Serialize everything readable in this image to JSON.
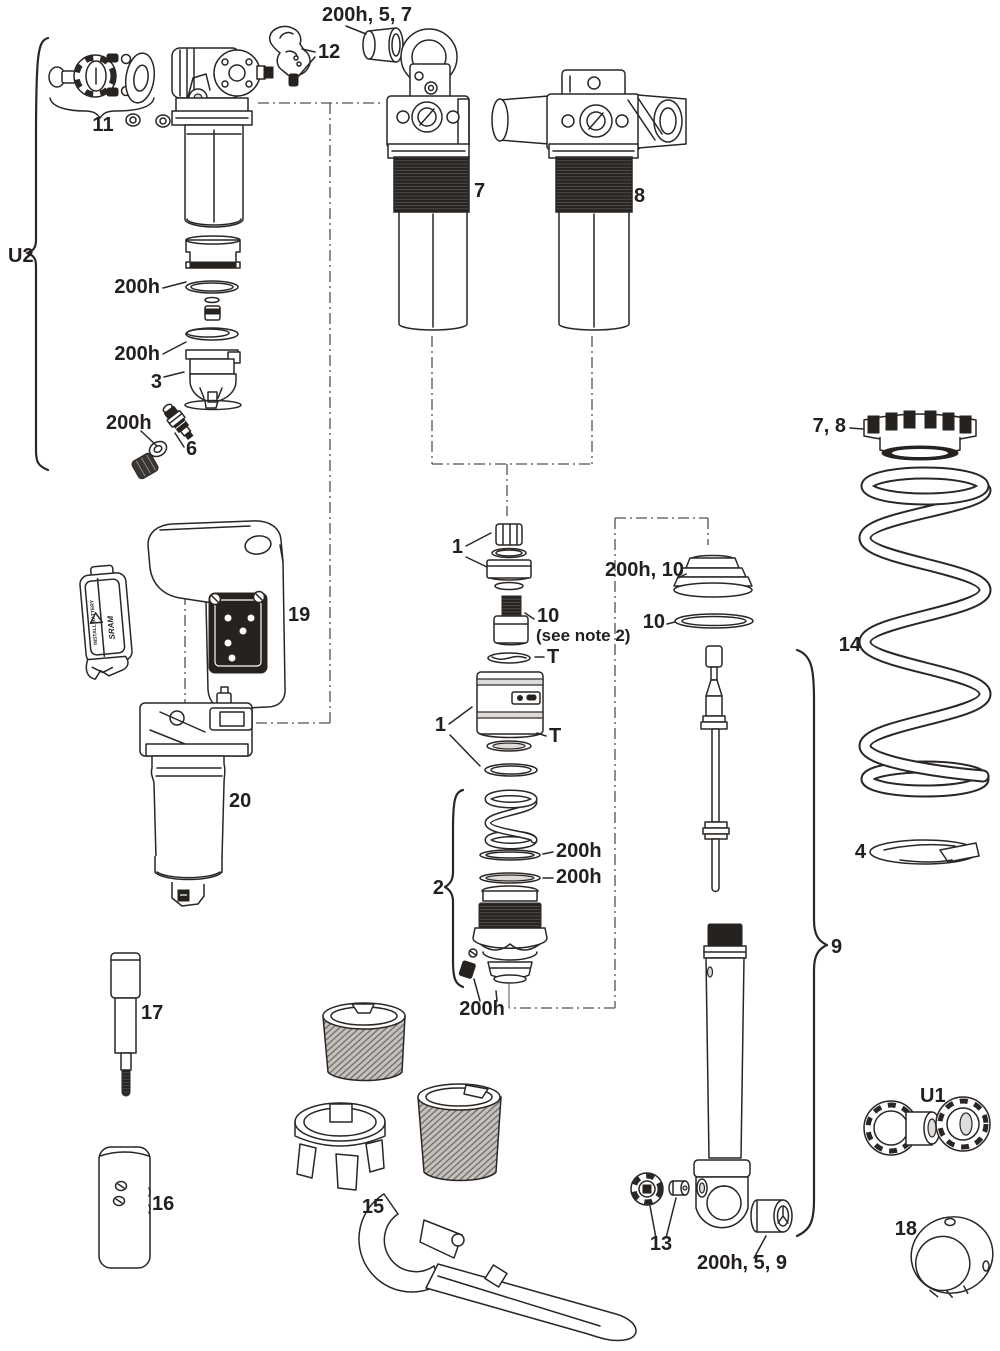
{
  "colors": {
    "ink": "#2a2624",
    "background": "#ffffff",
    "dark_fill": "#26221f"
  },
  "labels": {
    "top_bushing": "200h, 5, 7",
    "part12": "12",
    "part11": "11",
    "u2": "U2",
    "seal_top": "200h",
    "seal_mid": "200h",
    "part3": "3",
    "seal_valve": "200h",
    "part6": "6",
    "part7": "7",
    "part8": "8",
    "collar": "7, 8",
    "part14": "14",
    "part4": "4",
    "hardware1_top": "1",
    "part10_note": "10",
    "note2": "(see note 2)",
    "t_upper": "T",
    "piston1": "1",
    "t_lower": "T",
    "bumper": "200h, 10",
    "bumper_washer": "10",
    "part2": "2",
    "seal_2a": "200h",
    "seal_2b": "200h",
    "seal_2c": "200h",
    "part19": "19",
    "part20": "20",
    "part17": "17",
    "part16": "16",
    "part15": "15",
    "part13": "13",
    "eyelet_bushing": "200h, 5, 9",
    "part9": "9",
    "u1": "U1",
    "part18": "18"
  },
  "battery": {
    "install": "INSTALL BATTERY",
    "brand": "SRAM"
  }
}
